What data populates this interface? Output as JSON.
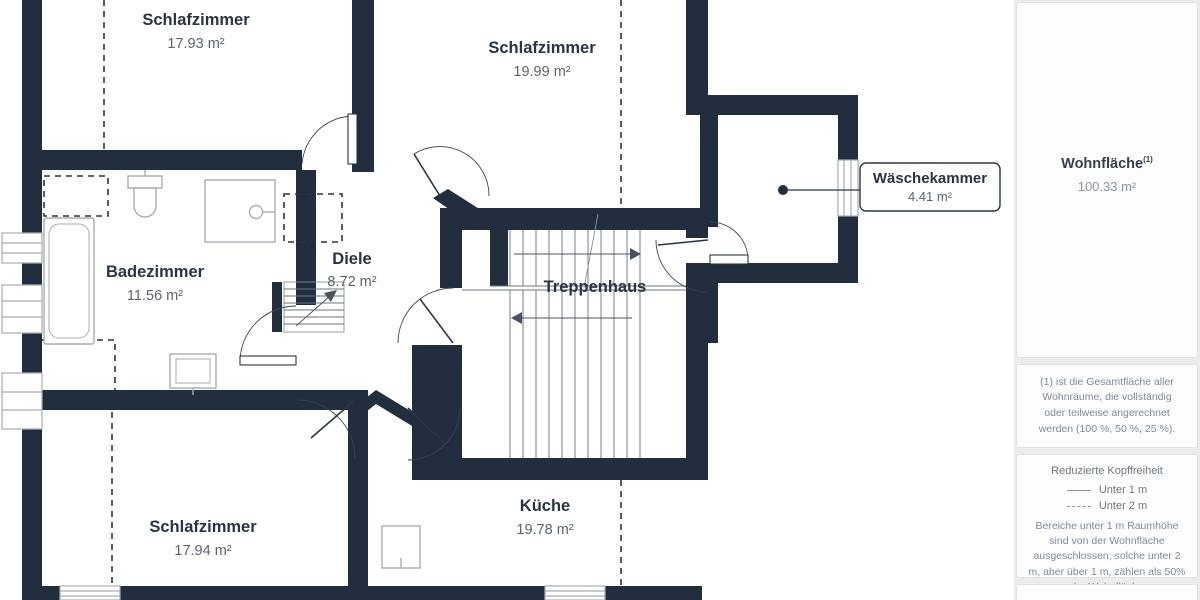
{
  "floorplan": {
    "rooms": {
      "schlafzimmer1": {
        "name": "Schlafzimmer",
        "area": "17.93 m²"
      },
      "schlafzimmer2": {
        "name": "Schlafzimmer",
        "area": "19.99 m²"
      },
      "badezimmer": {
        "name": "Badezimmer",
        "area": "11.56 m²"
      },
      "diele": {
        "name": "Diele",
        "area": "8.72 m²"
      },
      "treppenhaus": {
        "name": "Treppenhaus"
      },
      "kueche": {
        "name": "Küche",
        "area": "19.78 m²"
      },
      "schlafzimmer3": {
        "name": "Schlafzimmer",
        "area": "17.94 m²"
      },
      "waeschekammer": {
        "name": "Wäschekammer",
        "area": "4.41 m²"
      }
    },
    "colors": {
      "wall": "#222d3e",
      "furniture_outline": "#a6adb5",
      "stair_line": "#6b7480",
      "label_title": "#2b3442",
      "label_area": "#5a6472"
    }
  },
  "sidebar": {
    "total": {
      "label": "Wohnfläche",
      "superscript": "(1)",
      "value": "100.33 m²"
    },
    "footnote": "(1) ist die Gesamtfläche aller Wohnräume, die vollständig oder teilweise angerechnet werden (100 %, 50 %, 25 %).",
    "legend": {
      "title": "Reduzierte Kopffreiheit",
      "items": [
        {
          "style": "solid",
          "label": "Unter 1 m"
        },
        {
          "style": "dashed",
          "label": "Unter 2 m"
        }
      ],
      "note": "Bereiche unter 1 m Raumhöhe sind von der Wohnfläche ausgeschlossen; solche unter 2 m, aber über 1 m, zählen als 50% der Wohnfläche"
    }
  }
}
